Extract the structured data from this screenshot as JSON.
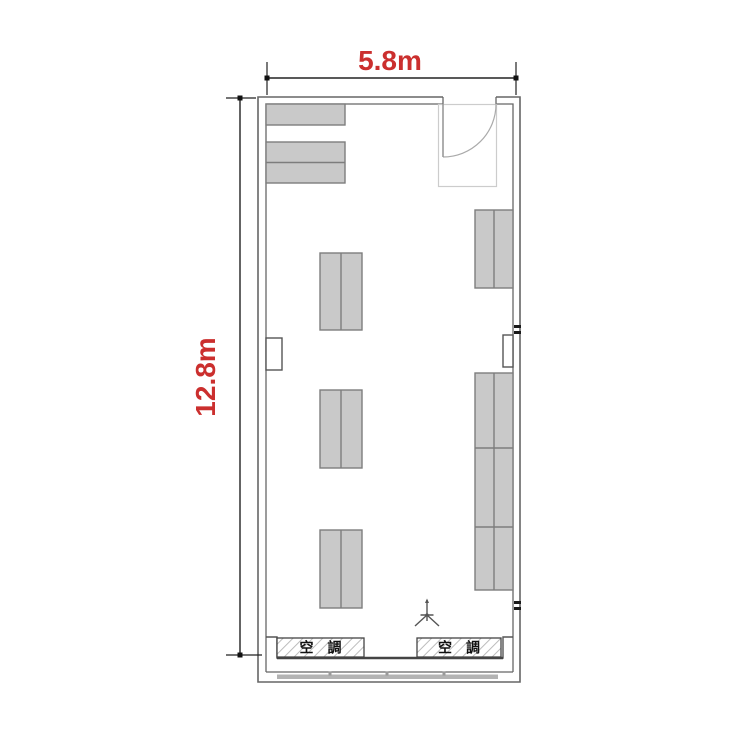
{
  "diagram": {
    "type": "architectural-floor-plan",
    "description_labels": {
      "width_dimension": "5.8m",
      "depth_dimension": "12.8m",
      "ac_unit": "空　調"
    }
  },
  "dimensions": {
    "width": {
      "label": "5.8m"
    },
    "height": {
      "label": "12.8m"
    }
  },
  "ac_units": [
    {
      "label": "空　調"
    },
    {
      "label": "空　調"
    }
  ],
  "colors": {
    "dimension_text": "#cb2f2e",
    "dimension_line": "#222222",
    "wall": "#666666",
    "wall_dark": "#555555",
    "desk_fill": "#c9c9c9",
    "desk_stroke": "#7d7d7d",
    "hatch_line": "#bdbdbd",
    "door_arc": "#aaaaaa",
    "window_band": "#b3b3b3",
    "outlet": "#1a1a1a"
  },
  "plan": {
    "room": {
      "x": 258,
      "y": 97,
      "w": 262,
      "h": 585,
      "door_gap": [
        443,
        496
      ]
    },
    "desks": [
      {
        "x": 266,
        "y": 104,
        "w": 79,
        "h": 21,
        "div": "none"
      },
      {
        "x": 266,
        "y": 142,
        "w": 79,
        "h": 41,
        "div": "h"
      },
      {
        "x": 320,
        "y": 253,
        "w": 42,
        "h": 77,
        "div": "v"
      },
      {
        "x": 320,
        "y": 390,
        "w": 42,
        "h": 78,
        "div": "v"
      },
      {
        "x": 320,
        "y": 530,
        "w": 42,
        "h": 78,
        "div": "v"
      },
      {
        "x": 475,
        "y": 210,
        "w": 38,
        "h": 78,
        "div": "v"
      },
      {
        "x": 475,
        "y": 373,
        "w": 38,
        "h": 217,
        "div": "v",
        "hdivs": [
          448,
          527
        ]
      }
    ],
    "columns": [
      {
        "x": 266,
        "y": 338,
        "w": 16,
        "h": 32
      },
      {
        "x": 503,
        "y": 335,
        "w": 10,
        "h": 32
      }
    ],
    "outlets": [
      {
        "x": 514,
        "y": 325
      },
      {
        "x": 514,
        "y": 601
      }
    ],
    "window_ticks": [
      330,
      387,
      444
    ]
  }
}
